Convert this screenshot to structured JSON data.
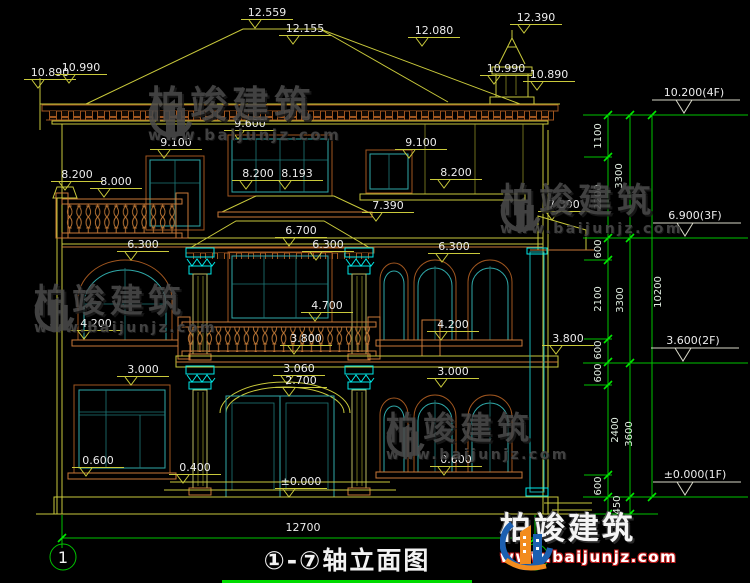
{
  "title": {
    "text": "①-⑦轴立面图",
    "axis_start": "1",
    "axis_end": "7"
  },
  "bottom_dim": {
    "value": "12700"
  },
  "watermark": {
    "brand": "柏竣建筑",
    "url": "www.baijunjz.com"
  },
  "logo": {
    "brand": "柏竣建筑",
    "url": "www.baijunjz.com"
  },
  "levels": [
    {
      "label": "10.200(4F)",
      "x": 694,
      "y": 115
    },
    {
      "label": "6.900(3F)",
      "x": 695,
      "y": 238
    },
    {
      "label": "3.600(2F)",
      "x": 693,
      "y": 363
    },
    {
      "label": "±0.000(1F)",
      "x": 695,
      "y": 497
    }
  ],
  "elevation_labels": [
    {
      "t": "12.559",
      "x": 267,
      "y": 16
    },
    {
      "t": "12.155",
      "x": 305,
      "y": 32
    },
    {
      "t": "12.080",
      "x": 434,
      "y": 34
    },
    {
      "t": "12.390",
      "x": 536,
      "y": 21
    },
    {
      "t": "10.890",
      "x": 50,
      "y": 76
    },
    {
      "t": "10.990",
      "x": 81,
      "y": 71
    },
    {
      "t": "10.990",
      "x": 506,
      "y": 72
    },
    {
      "t": "10.890",
      "x": 549,
      "y": 78
    },
    {
      "t": "9.600",
      "x": 250,
      "y": 127
    },
    {
      "t": "9.100",
      "x": 176,
      "y": 146
    },
    {
      "t": "9.100",
      "x": 421,
      "y": 146
    },
    {
      "t": "8.200",
      "x": 77,
      "y": 178
    },
    {
      "t": "8.000",
      "x": 116,
      "y": 185
    },
    {
      "t": "8.200",
      "x": 258,
      "y": 177
    },
    {
      "t": "8.193",
      "x": 297,
      "y": 177
    },
    {
      "t": "8.200",
      "x": 456,
      "y": 176
    },
    {
      "t": "7.390",
      "x": 388,
      "y": 209
    },
    {
      "t": "7.390",
      "x": 564,
      "y": 208
    },
    {
      "t": "6.700",
      "x": 301,
      "y": 234
    },
    {
      "t": "6.300",
      "x": 143,
      "y": 248
    },
    {
      "t": "6.300",
      "x": 328,
      "y": 248
    },
    {
      "t": "6.300",
      "x": 454,
      "y": 250
    },
    {
      "t": "4.700",
      "x": 327,
      "y": 309
    },
    {
      "t": "4.200",
      "x": 96,
      "y": 327
    },
    {
      "t": "4.200",
      "x": 453,
      "y": 328
    },
    {
      "t": "3.800",
      "x": 306,
      "y": 342
    },
    {
      "t": "3.800",
      "x": 568,
      "y": 342
    },
    {
      "t": "3.060",
      "x": 299,
      "y": 372
    },
    {
      "t": "2.700",
      "x": 301,
      "y": 384
    },
    {
      "t": "3.000",
      "x": 143,
      "y": 373
    },
    {
      "t": "3.000",
      "x": 453,
      "y": 375
    },
    {
      "t": "0.600",
      "x": 98,
      "y": 464
    },
    {
      "t": "0.400",
      "x": 195,
      "y": 471
    },
    {
      "t": "±0.000",
      "x": 301,
      "y": 485
    },
    {
      "t": "0.600",
      "x": 456,
      "y": 463
    }
  ],
  "green_dims": [
    {
      "t": "1100",
      "x": 601,
      "y": 136
    },
    {
      "t": "3300",
      "x": 622,
      "y": 176
    },
    {
      "t": "2200",
      "x": 601,
      "y": 197
    },
    {
      "t": "600",
      "x": 601,
      "y": 249
    },
    {
      "t": "2100",
      "x": 601,
      "y": 299
    },
    {
      "t": "3300",
      "x": 623,
      "y": 300
    },
    {
      "t": "10200",
      "x": 661,
      "y": 292
    },
    {
      "t": "600",
      "x": 601,
      "y": 350
    },
    {
      "t": "600",
      "x": 601,
      "y": 373
    },
    {
      "t": "2400",
      "x": 618,
      "y": 430
    },
    {
      "t": "3600",
      "x": 632,
      "y": 434
    },
    {
      "t": "600",
      "x": 601,
      "y": 486
    },
    {
      "t": "450",
      "x": 620,
      "y": 505
    }
  ],
  "colors": {
    "background": "#000000",
    "cad_yellow": "#C9C93B",
    "dim_green": "#00C300",
    "frame_teal": "#2FA8A8",
    "capital_cyan": "#00E8E8",
    "trim_brown": "#A0561F",
    "white_text": "#ECECEC",
    "logo_blue": "#1C5FB0",
    "logo_orange": "#F28C1E"
  }
}
